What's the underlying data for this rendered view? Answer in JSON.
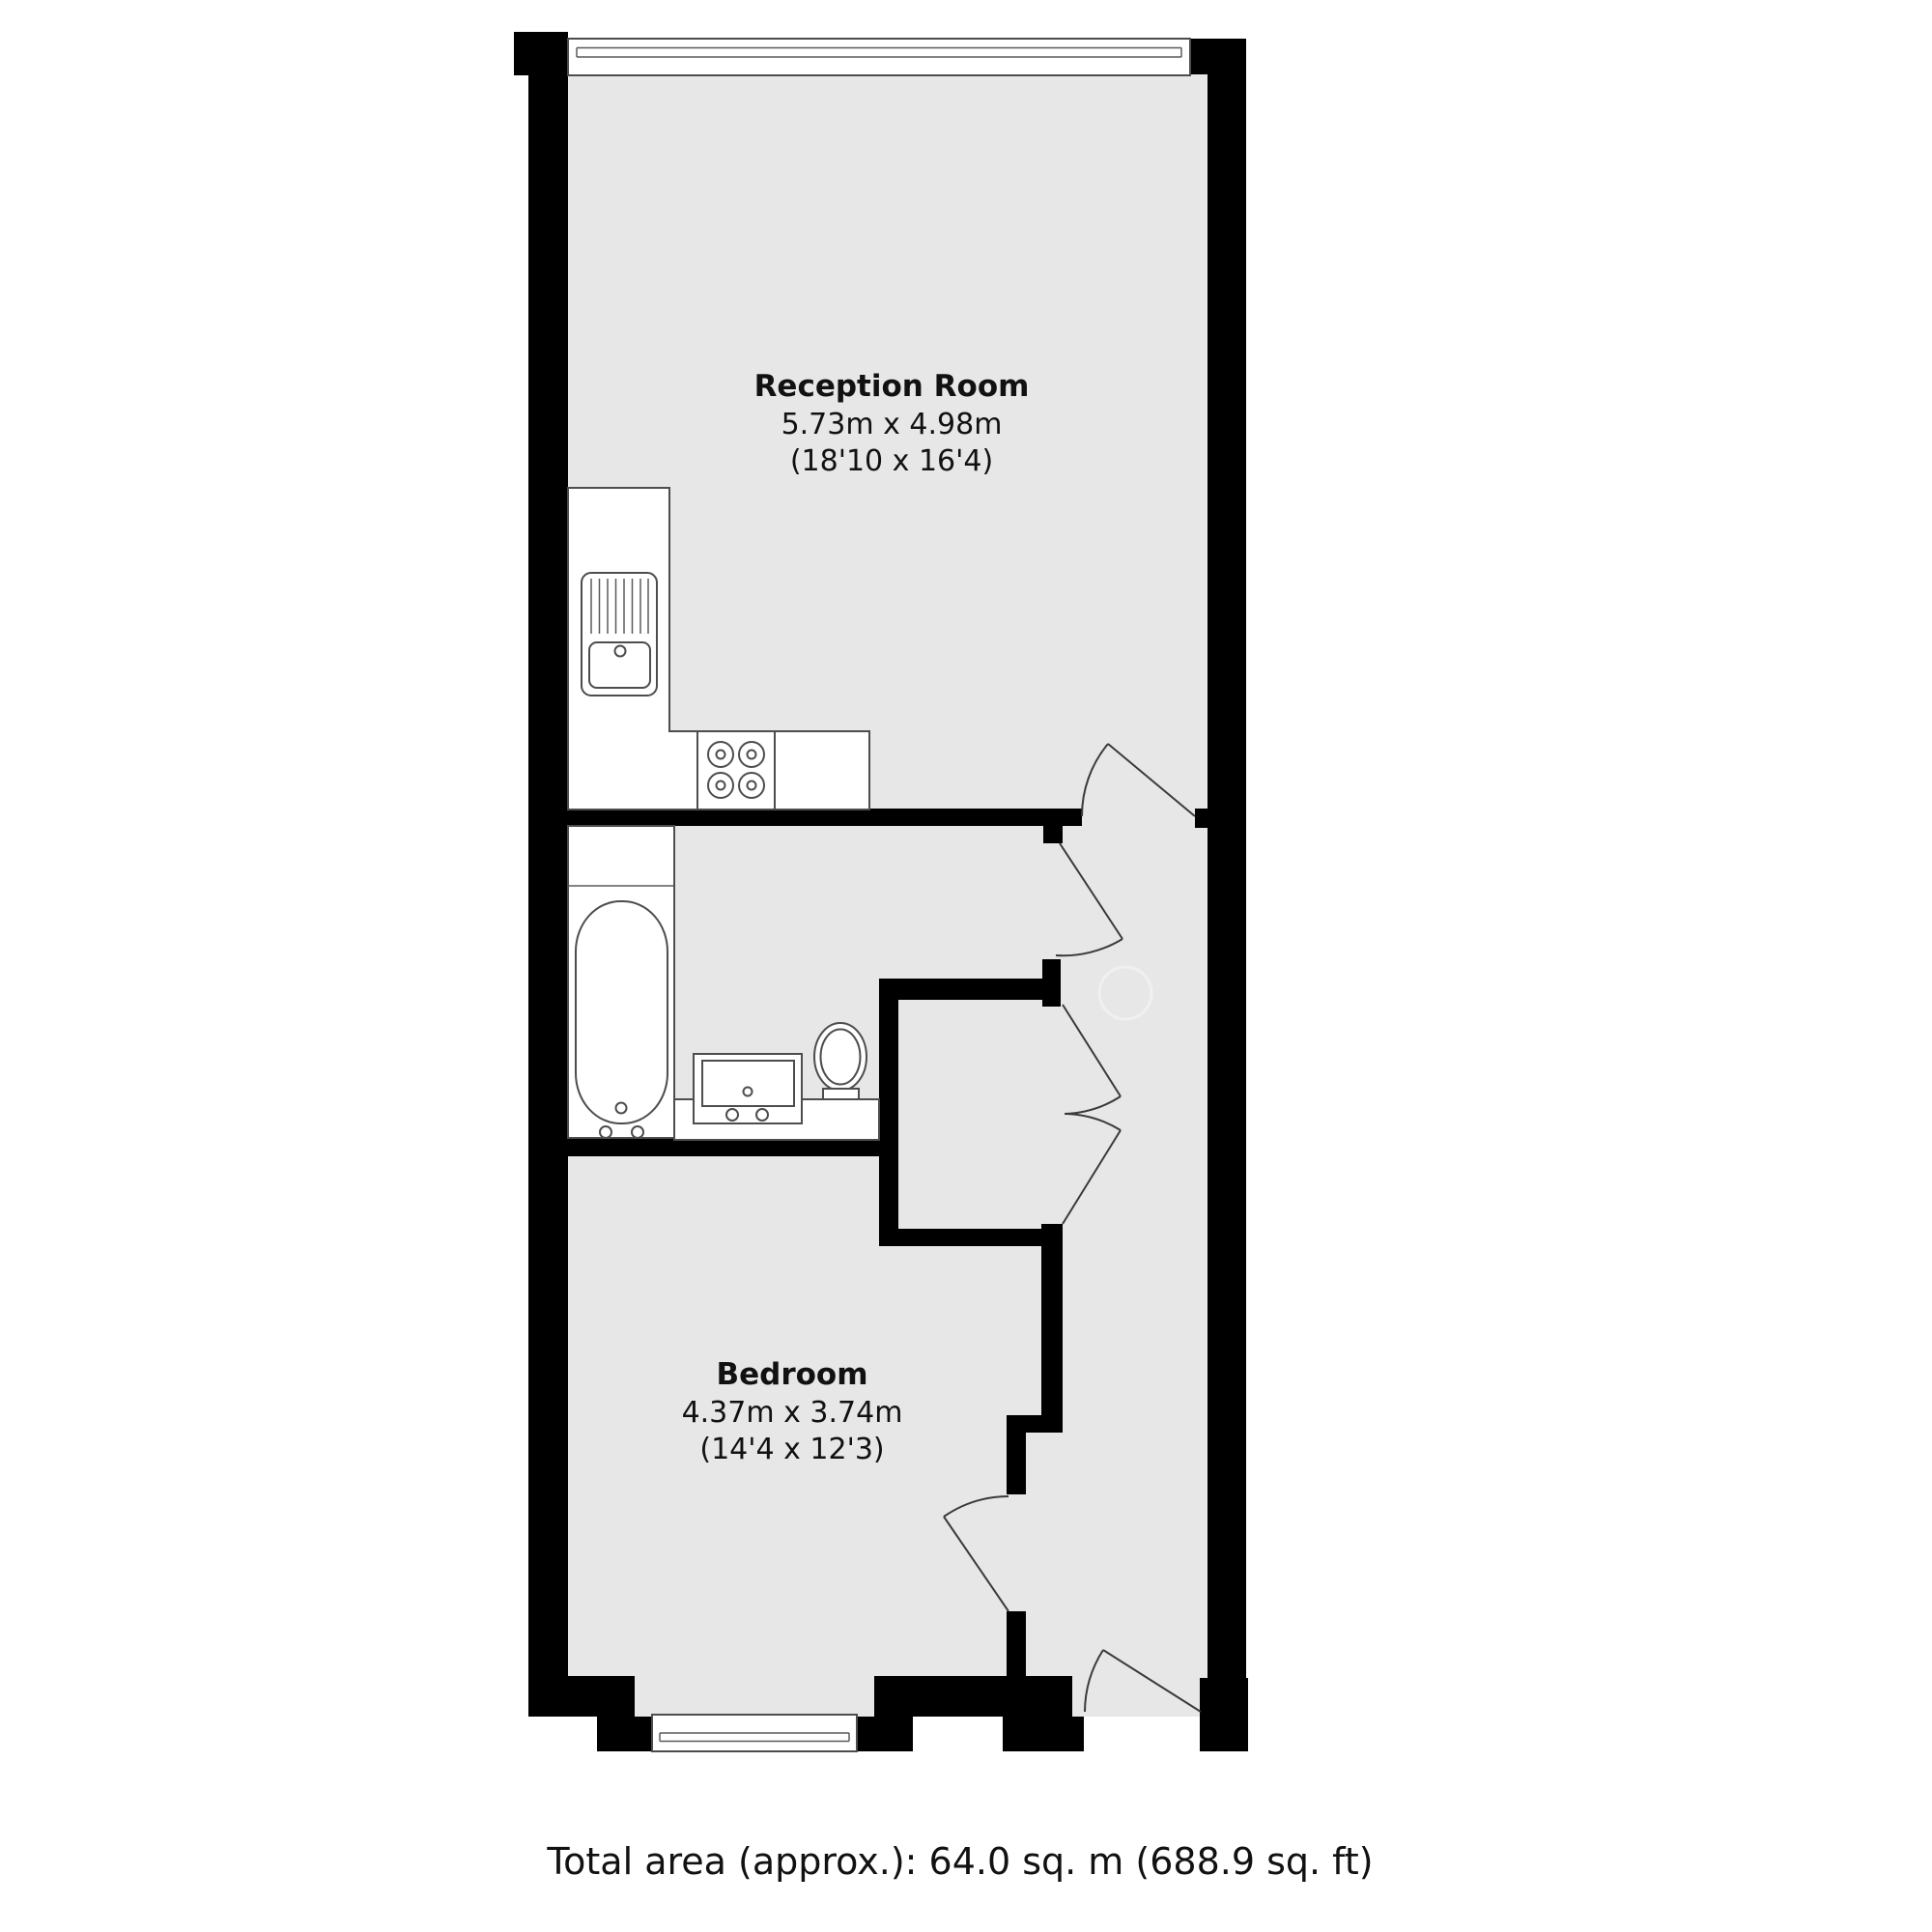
{
  "plan": {
    "type": "residential-floorplan",
    "rooms": [
      {
        "id": "reception",
        "name": "Reception Room",
        "dim_metric": "5.73m x 4.98m",
        "dim_imperial": "(18'10 x 16'4)"
      },
      {
        "id": "bedroom",
        "name": "Bedroom",
        "dim_metric": "4.37m x 3.74m",
        "dim_imperial": "(14'4 x 12'3)"
      }
    ],
    "fixtures": [
      "kitchen-sink-drainer-icon",
      "hob-four-burners-icon",
      "bathtub-icon",
      "vanity-basin-icon",
      "toilet-icon",
      "window-glazing-icon",
      "door-swing-arc-icon"
    ],
    "doors": [
      "reception-to-hall-door",
      "bathroom-door",
      "closet-double-door-upper",
      "closet-double-door-lower",
      "bedroom-door",
      "entrance-door"
    ],
    "colors": {
      "floor_fill": "#e7e7e7",
      "wall_fill": "#000000",
      "fixture_outline": "#4d4d4d",
      "background": "#ffffff"
    }
  },
  "footer": {
    "total_area": "Total area (approx.): 64.0 sq. m (688.9 sq. ft)"
  }
}
